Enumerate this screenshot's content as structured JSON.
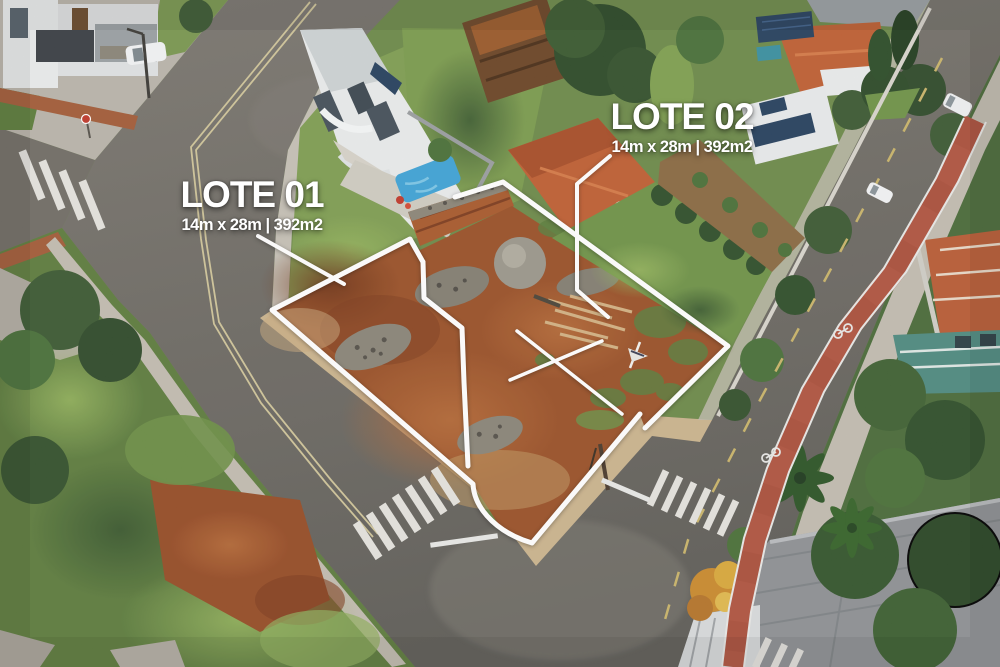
{
  "scene": {
    "description": "Aerial drone photo of two vacant corner land lots outlined in white in a residential neighborhood with streets, houses, pool and trees"
  },
  "labels": {
    "lot01": {
      "title": "LOTE 01",
      "dimensions": "14m x 28m | 392m2"
    },
    "lot02": {
      "title": "LOTE 02",
      "dimensions": "14m x 28m | 392m2"
    }
  },
  "colors": {
    "overlay_white": "#ffffff",
    "lot_soil_red": "#9a5128",
    "asphalt_gray": "#6b6862",
    "bike_lane_red": "#b05440",
    "grass_green": "#7a9750",
    "lawn_green": "#6f9348",
    "roof_terracotta": "#bf5f33",
    "pool_blue": "#41a8d8",
    "solar_panel_blue": "#26415e",
    "sidewalk_concrete": "#c5c0b6",
    "center_line_yellow": "#c9b46a"
  }
}
